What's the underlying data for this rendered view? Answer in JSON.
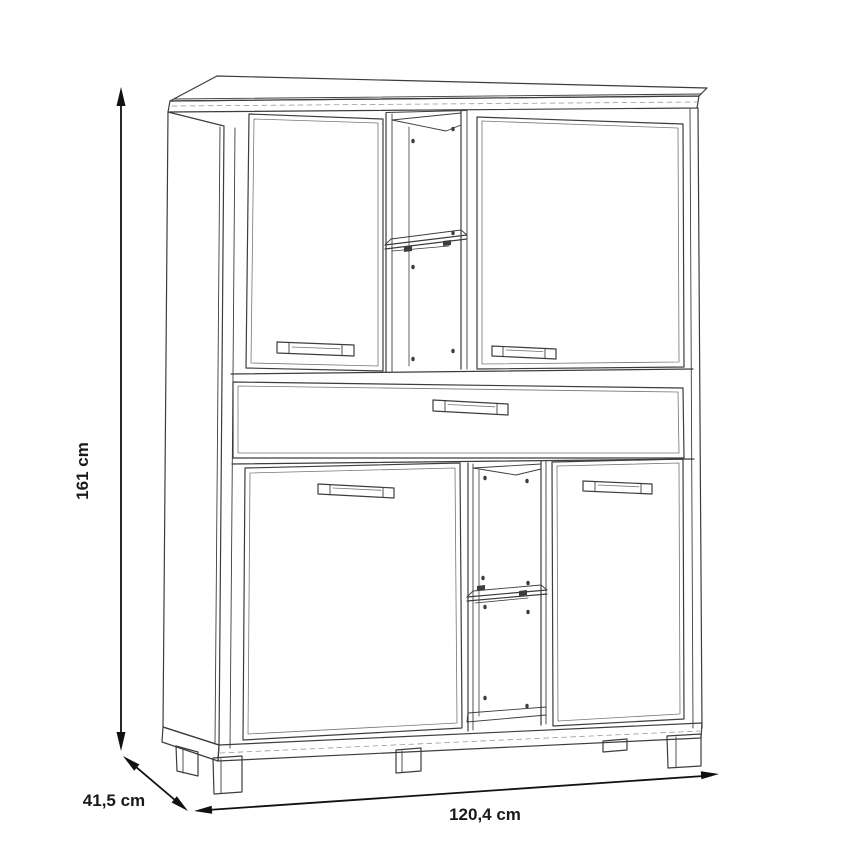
{
  "page": {
    "background_color": "#ffffff"
  },
  "diagram": {
    "type": "furniture-dimension-line-drawing",
    "subject": "cabinet with 4 doors, 1 drawer and 2 open shelf compartments",
    "colors": {
      "cabinet_line": "#3d3d3d",
      "inner_line": "#767676",
      "dimension_line": "#111111",
      "label_text": "#1a1a1a"
    },
    "dimensions": {
      "height": {
        "label": "161 cm"
      },
      "depth": {
        "label": "41,5 cm"
      },
      "width": {
        "label": "120,4 cm"
      }
    }
  }
}
